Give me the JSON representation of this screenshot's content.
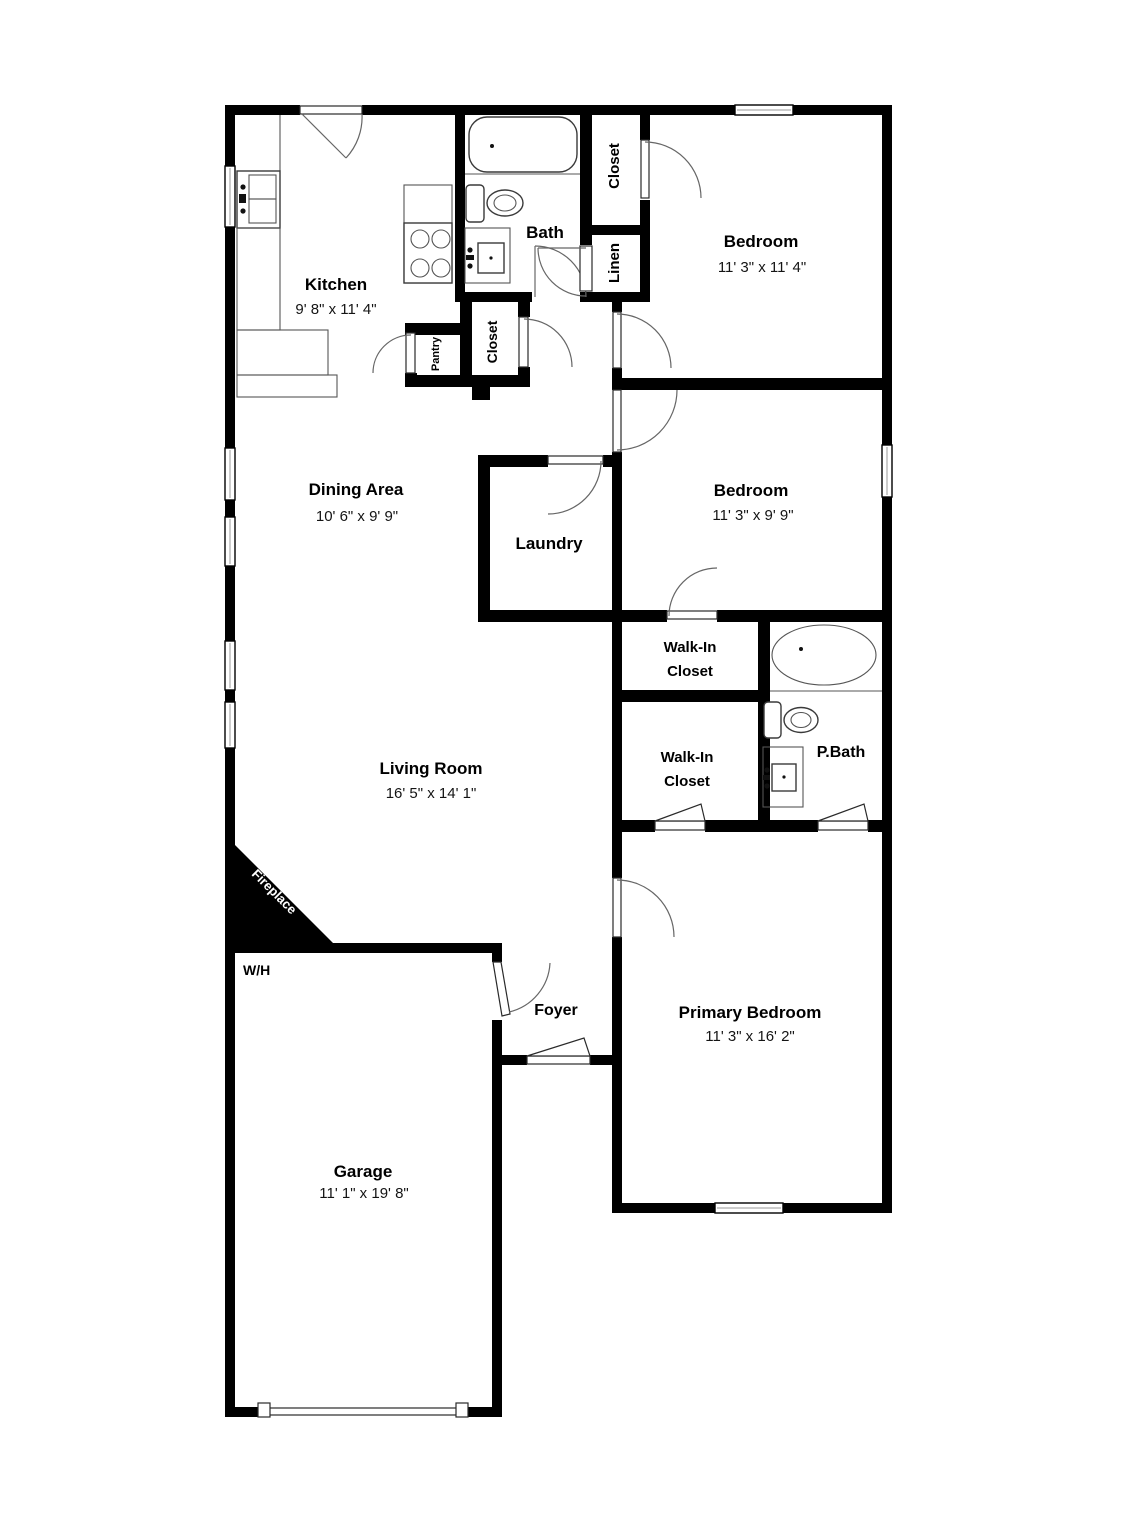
{
  "plan_type": "floor-plan",
  "colors": {
    "walls": "#000000",
    "background": "#ffffff",
    "fixture_stroke": "#3a3a3a",
    "text": "#000000",
    "fireplace_text": "#ffffff"
  },
  "rooms": {
    "kitchen": {
      "name": "Kitchen",
      "dims": "9' 8\" x 11' 4\""
    },
    "bath": {
      "name": "Bath"
    },
    "closet_top": {
      "name": "Closet"
    },
    "linen": {
      "name": "Linen"
    },
    "bedroom1": {
      "name": "Bedroom",
      "dims": "11' 3\" x 11' 4\""
    },
    "pantry": {
      "name": "Pantry"
    },
    "closet_hall": {
      "name": "Closet"
    },
    "dining": {
      "name": "Dining Area",
      "dims": "10' 6\" x 9' 9\""
    },
    "laundry": {
      "name": "Laundry"
    },
    "bedroom2": {
      "name": "Bedroom",
      "dims": "11' 3\" x 9' 9\""
    },
    "wic1": {
      "line1": "Walk-In",
      "line2": "Closet"
    },
    "wic2": {
      "line1": "Walk-In",
      "line2": "Closet"
    },
    "pbath": {
      "name": "P.Bath"
    },
    "living": {
      "name": "Living Room",
      "dims": "16' 5\" x 14' 1\""
    },
    "fireplace": {
      "name": "Fireplace"
    },
    "wh": {
      "name": "W/H"
    },
    "foyer": {
      "name": "Foyer"
    },
    "primary": {
      "name": "Primary Bedroom",
      "dims": "11' 3\" x 16' 2\""
    },
    "garage": {
      "name": "Garage",
      "dims": "11' 1\" x 19' 8\""
    }
  },
  "fixtures": [
    "bathtub",
    "toilet",
    "sink-vanity",
    "kitchen-sink",
    "stove",
    "oval-bathtub",
    "fireplace",
    "garage-door",
    "windows",
    "door-swings"
  ]
}
